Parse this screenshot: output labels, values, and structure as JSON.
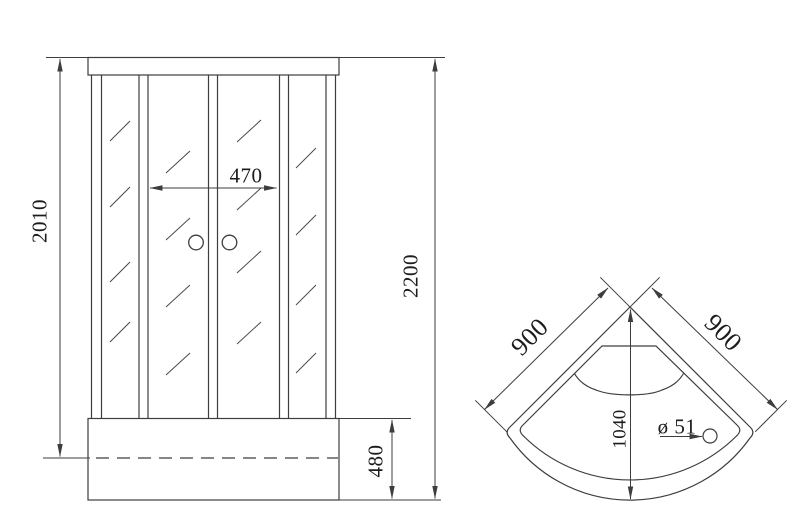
{
  "labels": {
    "front": {
      "glass_height": "2010",
      "door_width": "470",
      "total_height": "2200",
      "tray_height": "480"
    },
    "top": {
      "side_left": "900",
      "side_right": "900",
      "front_diagonal": "1040",
      "drain_diameter": "ø 51"
    }
  }
}
